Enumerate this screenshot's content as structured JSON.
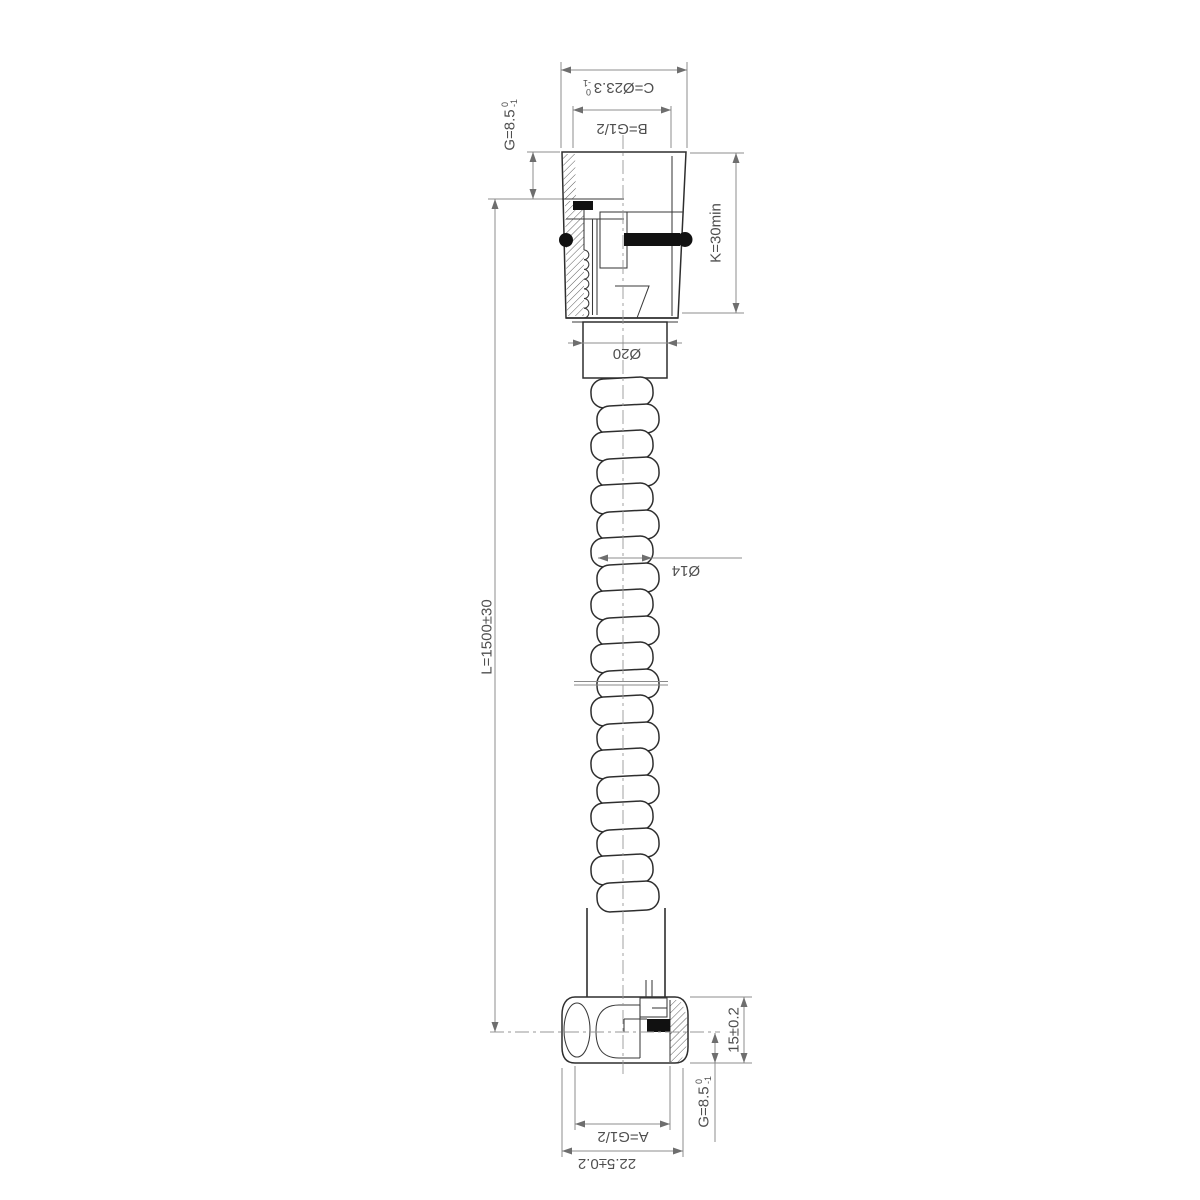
{
  "drawing": {
    "type": "technical-drawing",
    "subject": "shower-hose-section",
    "colors": {
      "background": "#ffffff",
      "object_line": "#2e2e2e",
      "dimension_line": "#8c8c8c",
      "text": "#4f4f4f",
      "seal_fill": "#111111"
    },
    "labels": {
      "c": "C=Ø23.3",
      "c_tol_upper": "0",
      "c_tol_lower": "-1",
      "b": "B=G1/2",
      "g_top": "G=8.5",
      "g_top_tol_upper": "0",
      "g_top_tol_lower": "-1",
      "k": "K=30min",
      "d20": "Ø20",
      "d14": "Ø14",
      "l": "L=1500±30",
      "len15": "15±0.2",
      "g_bottom": "G=8.5",
      "g_bottom_tol_upper": "0",
      "g_bottom_tol_lower": "-1",
      "a": "A=G1/2",
      "w225": "22.5±0.2"
    }
  }
}
